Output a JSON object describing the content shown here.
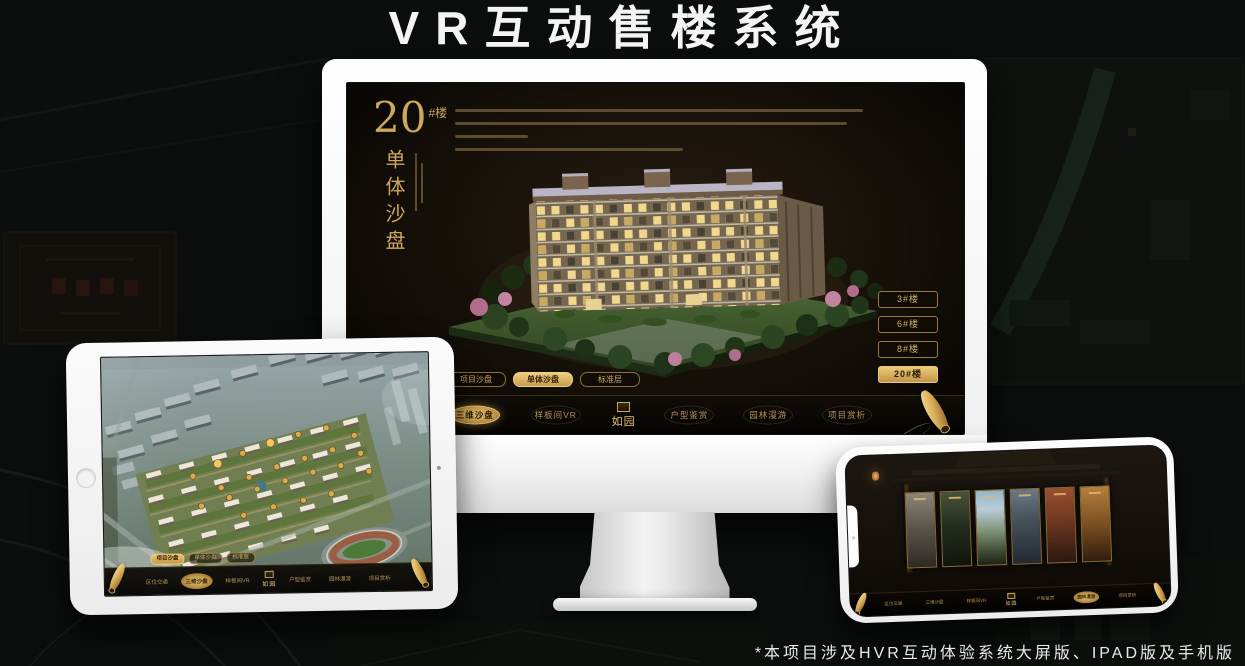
{
  "page": {
    "title": "VR互动售楼系统",
    "footnote": "*本项目涉及HVR互动体验系统大屏版、IPAD版及手机版"
  },
  "brand": {
    "logo_text": "如园"
  },
  "nav": {
    "items": [
      {
        "label": "区位交通"
      },
      {
        "label": "三维沙盘"
      },
      {
        "label": "样板间VR"
      },
      {
        "label": "户型鉴赏"
      },
      {
        "label": "园林漫游"
      },
      {
        "label": "项目赏析"
      }
    ]
  },
  "monitor": {
    "heading": {
      "number": "20",
      "suffix": "#楼",
      "subtitle": "单体沙盘"
    },
    "floor_buttons": [
      {
        "label": "3#楼",
        "active": false
      },
      {
        "label": "6#楼",
        "active": false
      },
      {
        "label": "8#楼",
        "active": false
      },
      {
        "label": "20#楼",
        "active": true
      }
    ],
    "view_tabs": [
      {
        "label": "项目沙盘",
        "active": false
      },
      {
        "label": "单体沙盘",
        "active": true
      },
      {
        "label": "标准层",
        "active": false
      }
    ],
    "active_nav": "三维沙盘"
  },
  "tablet": {
    "view_tabs": [
      {
        "label": "项目沙盘",
        "active": true
      },
      {
        "label": "单体沙盘",
        "active": false
      },
      {
        "label": "标准层",
        "active": false
      }
    ],
    "active_nav": "三维沙盘"
  },
  "phone": {
    "active_nav": "园林漫游",
    "gallery_panel_count": 6
  },
  "colors": {
    "gold": "#c9a45a",
    "gold_bright": "#e8c873",
    "gold_active_bg": "#d9b05c",
    "screen_bg": "#140f0a",
    "title_white": "#f2f2f2"
  }
}
